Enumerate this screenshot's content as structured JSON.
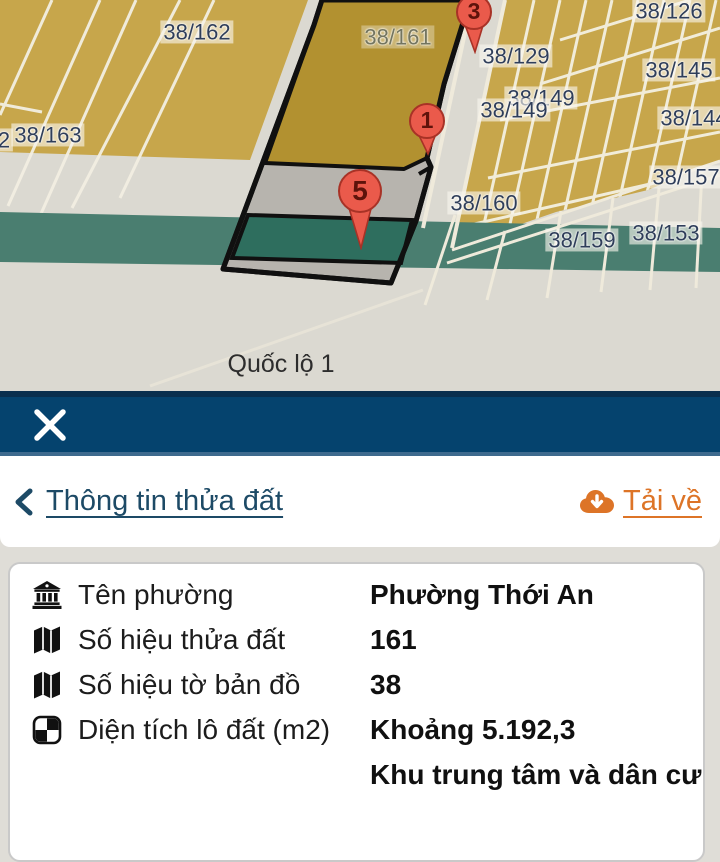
{
  "map": {
    "parcel_labels": [
      {
        "text": "38/162",
        "x": 197,
        "y": 32
      },
      {
        "text": "38/161",
        "x": 398,
        "y": 37,
        "muted": true
      },
      {
        "text": "38/126",
        "x": 669,
        "y": 11
      },
      {
        "text": "38/129",
        "x": 516,
        "y": 56
      },
      {
        "text": "38/145",
        "x": 679,
        "y": 70
      },
      {
        "text": "38/149",
        "x": 541,
        "y": 98
      },
      {
        "text": "38/149",
        "x": 514,
        "y": 110
      },
      {
        "text": "38/144",
        "x": 694,
        "y": 118
      },
      {
        "text": "2",
        "x": 4,
        "y": 140
      },
      {
        "text": "38/163",
        "x": 48,
        "y": 135
      },
      {
        "text": "38/157",
        "x": 686,
        "y": 177
      },
      {
        "text": "38/160",
        "x": 484,
        "y": 203
      },
      {
        "text": "38/159",
        "x": 582,
        "y": 240
      },
      {
        "text": "38/153",
        "x": 666,
        "y": 233
      }
    ],
    "road_label": {
      "text": "Quốc lộ 1",
      "x": 281,
      "y": 364
    },
    "markers": [
      {
        "number": "3",
        "x": 474,
        "head_y": 12,
        "r": 17,
        "tip_y": 50
      },
      {
        "number": "1",
        "x": 427,
        "head_y": 121,
        "r": 17,
        "tip_y": 152
      },
      {
        "number": "5",
        "x": 360,
        "head_y": 191,
        "r": 21,
        "tip_y": 246
      }
    ],
    "colors": {
      "parcel_gold": "#c7a64b",
      "selected_gold": "#b29130",
      "green_band": "#4a7e70",
      "selected_green": "#2e6e5e",
      "road_gray": "#dbd9d1",
      "selected_gray": "#b7b4ae",
      "marker_red": "#ea5a4b",
      "label_blue": "#2f3e5a"
    }
  },
  "navbar": {
    "close_icon": "close"
  },
  "header": {
    "back_label": "Thông tin thửa đất",
    "download_label": "Tải về",
    "link_blue": "#1d4a66",
    "download_orange": "#dd7427"
  },
  "details": {
    "rows": [
      {
        "icon": "bank",
        "label": "Tên phường",
        "value": "Phường Thới An"
      },
      {
        "icon": "map",
        "label": "Số hiệu thửa đất",
        "value": "161"
      },
      {
        "icon": "map",
        "label": "Số hiệu tờ bản đồ",
        "value": "38"
      },
      {
        "icon": "quadrant",
        "label": "Diện tích lô đất (m2)",
        "value": "Khoảng 5.192,3"
      },
      {
        "icon": "",
        "label": "",
        "value": "Khu trung tâm và dân cư"
      }
    ]
  }
}
